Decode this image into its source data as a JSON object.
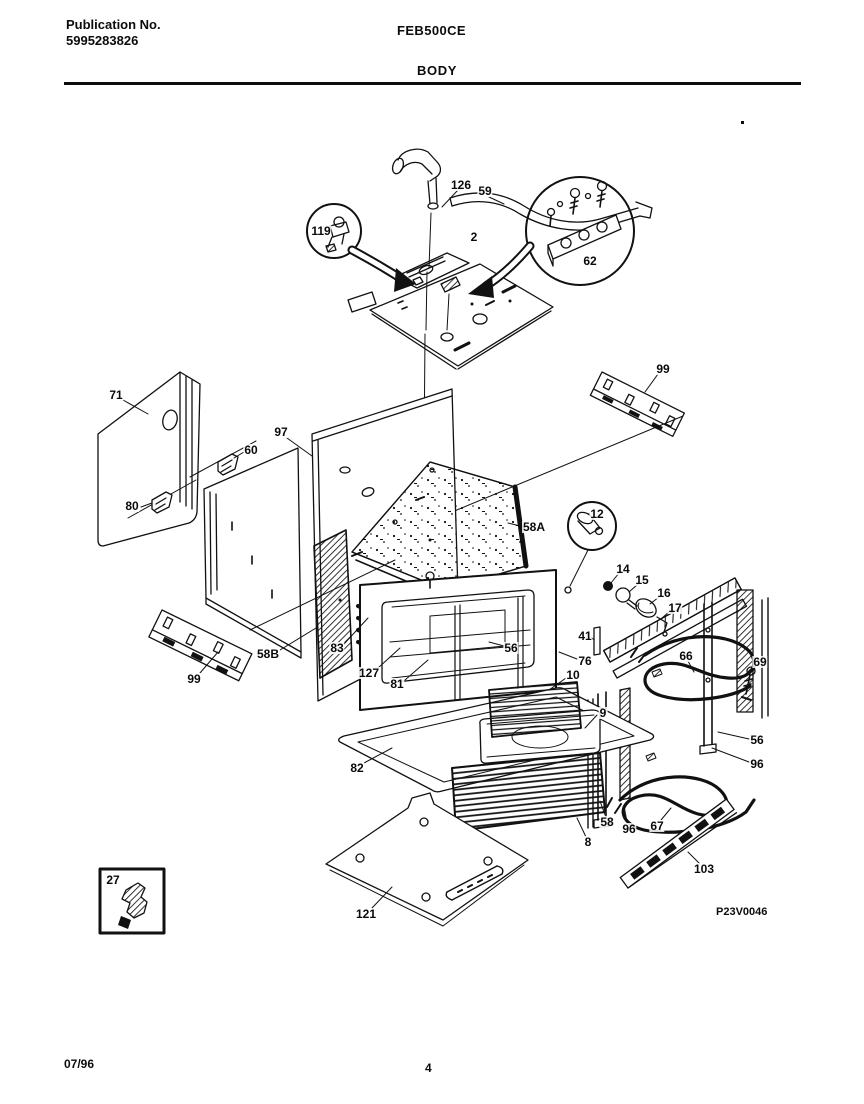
{
  "page": {
    "publication_label": "Publication No.",
    "publication_number": "5995283826",
    "model": "FEB500CE",
    "section_title": "BODY",
    "drawing_code": "P23V0046",
    "date": "07/96",
    "page_number": "4"
  },
  "colors": {
    "ink": "#0c0c0c",
    "paper": "#ffffff"
  },
  "diagram": {
    "description": "Exploded parts view of oven body",
    "callouts": [
      {
        "label": "126",
        "x": 461,
        "y": 185
      },
      {
        "label": "59",
        "x": 485,
        "y": 191
      },
      {
        "label": "119",
        "x": 321,
        "y": 231
      },
      {
        "label": "2",
        "x": 474,
        "y": 237
      },
      {
        "label": "62",
        "x": 590,
        "y": 261
      },
      {
        "label": "99",
        "x": 663,
        "y": 369
      },
      {
        "label": "71",
        "x": 116,
        "y": 395
      },
      {
        "label": "60",
        "x": 251,
        "y": 450
      },
      {
        "label": "97",
        "x": 281,
        "y": 432
      },
      {
        "label": "80",
        "x": 132,
        "y": 506
      },
      {
        "label": "58A",
        "x": 534,
        "y": 527
      },
      {
        "label": "12",
        "x": 597,
        "y": 514
      },
      {
        "label": "14",
        "x": 623,
        "y": 569
      },
      {
        "label": "15",
        "x": 642,
        "y": 580
      },
      {
        "label": "16",
        "x": 664,
        "y": 593
      },
      {
        "label": "17",
        "x": 675,
        "y": 608
      },
      {
        "label": "41",
        "x": 585,
        "y": 636
      },
      {
        "label": "58B",
        "x": 268,
        "y": 654
      },
      {
        "label": "83",
        "x": 337,
        "y": 648
      },
      {
        "label": "56",
        "x": 511,
        "y": 648
      },
      {
        "label": "76",
        "x": 585,
        "y": 661
      },
      {
        "label": "127",
        "x": 369,
        "y": 673
      },
      {
        "label": "81",
        "x": 397,
        "y": 684
      },
      {
        "label": "10",
        "x": 573,
        "y": 675
      },
      {
        "label": "99",
        "x": 194,
        "y": 679
      },
      {
        "label": "66",
        "x": 686,
        "y": 656
      },
      {
        "label": "69",
        "x": 760,
        "y": 662
      },
      {
        "label": "82",
        "x": 357,
        "y": 768
      },
      {
        "label": "9",
        "x": 603,
        "y": 713
      },
      {
        "label": "56",
        "x": 757,
        "y": 740
      },
      {
        "label": "96",
        "x": 757,
        "y": 764
      },
      {
        "label": "58",
        "x": 607,
        "y": 822
      },
      {
        "label": "96",
        "x": 629,
        "y": 829
      },
      {
        "label": "67",
        "x": 657,
        "y": 826
      },
      {
        "label": "8",
        "x": 588,
        "y": 842
      },
      {
        "label": "103",
        "x": 704,
        "y": 869
      },
      {
        "label": "121",
        "x": 366,
        "y": 914
      },
      {
        "label": "27",
        "x": 113,
        "y": 880
      }
    ]
  }
}
